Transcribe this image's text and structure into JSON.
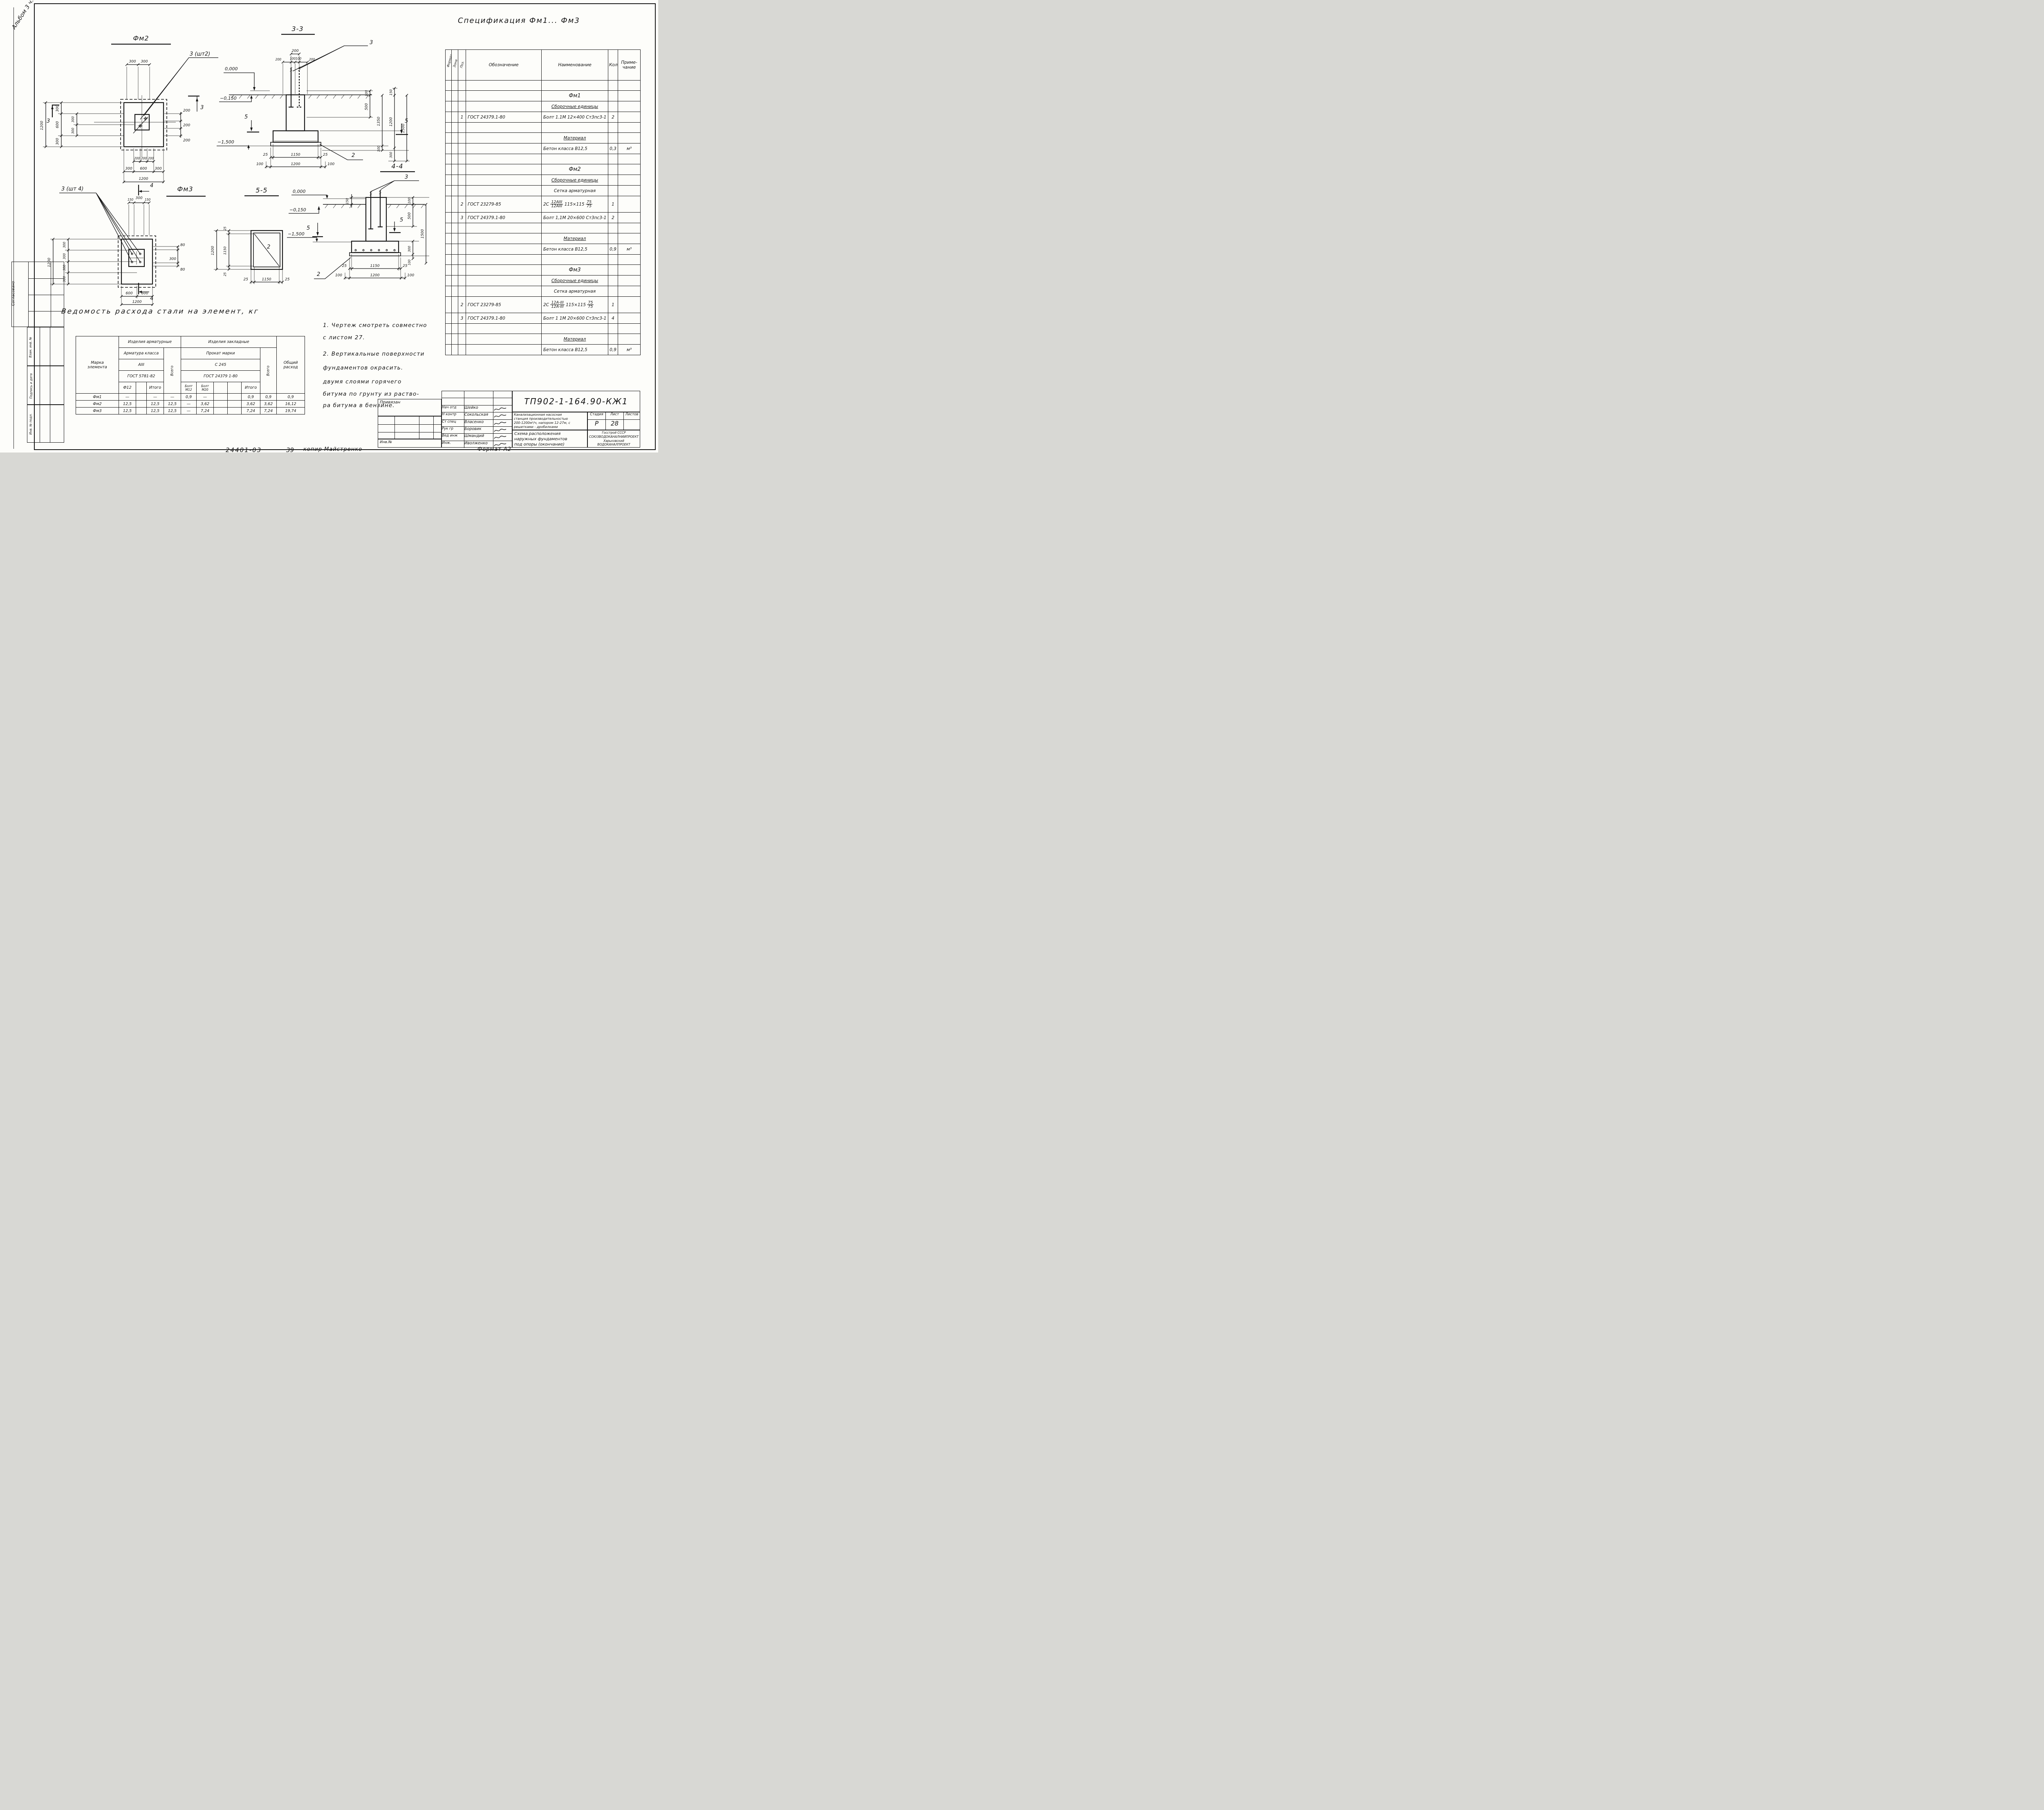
{
  "frame": {
    "album_note": "Альбом 3 ч.1",
    "stamp_agreed": "Согласовано",
    "stamp_vzam": "Взам. инв. №",
    "stamp_sign": "Подпись и дата",
    "stamp_inv": "Инв. № подл."
  },
  "footer": {
    "order_no": "24401-03",
    "num": "39",
    "copier": "копир Майстренко",
    "format": "Формат А2"
  },
  "fm2": {
    "title": "Фм2",
    "leader": "3 (шт2)",
    "mark": "3",
    "dims": {
      "top": [
        "300",
        "300"
      ],
      "left_total": "1200",
      "left_chain": [
        "300",
        "600",
        "300"
      ],
      "left_inner": [
        "300",
        "300"
      ],
      "right": [
        "200",
        "200",
        "200"
      ],
      "bot1": [
        "200",
        "200",
        "200"
      ],
      "bot2": [
        "300",
        "600",
        "300"
      ],
      "bot3": "1200"
    }
  },
  "s33": {
    "title": "3-3",
    "leader3": "3",
    "leader2": "2",
    "mark5": "5",
    "lev": [
      "0,000",
      "−0,150",
      "−1,500"
    ],
    "dims": {
      "t200": "200",
      "t100l": "100",
      "t100r": "100",
      "t200l": "200",
      "t200r": "200",
      "rA": [
        "100",
        "500"
      ],
      "rB": [
        "1350",
        "100"
      ],
      "rC": [
        "150",
        "1200",
        "300"
      ],
      "rD": "1500",
      "b1": [
        "25",
        "1150",
        "25"
      ],
      "b2": [
        "100",
        "1200",
        "100"
      ]
    }
  },
  "fm3": {
    "title": "Фм3",
    "leader": "3 (шт 4)",
    "mark4": "4",
    "dims": {
      "top": [
        "150",
        "300",
        "150"
      ],
      "left_total": "1200",
      "left_chain": [
        "300",
        "300",
        "300",
        "300"
      ],
      "right": [
        "80",
        "300",
        "80"
      ],
      "bot1": [
        "600",
        "600"
      ],
      "bot2": "1200"
    }
  },
  "s55": {
    "title": "5-5",
    "plate": "2",
    "dims": {
      "left_total": "1200",
      "left_chain": [
        "25",
        "1150",
        "25"
      ],
      "bot": [
        "25",
        "1150",
        "25"
      ]
    }
  },
  "s44": {
    "title": "4-4",
    "leader3": "3",
    "leader2": "2",
    "mark5": "5",
    "lev": [
      "0,000",
      "−0,150",
      "−1,500"
    ],
    "dims": {
      "l150": "150",
      "rA": [
        "100",
        "500"
      ],
      "r1500": "1500",
      "rB": [
        "300",
        "100"
      ],
      "b1": [
        "25",
        "1150",
        "25"
      ],
      "b2": [
        "100",
        "1200",
        "100"
      ]
    }
  },
  "steel": {
    "title": "Ведомость    расхода    стали    на    элемент, кг",
    "mark1": "Марка",
    "mark2": "элемента",
    "g1": "Изделия арматурные",
    "g2": "Изделия   закладные",
    "cls1": "Арматура класса",
    "v1": "АIII",
    "gost1": "ГОСТ 5781-82",
    "cls2": "Прокат       марки",
    "v2": "С 245",
    "gost2": "ГОСТ 24379 1-80",
    "f12": "Ф12",
    "itogo": "Итого",
    "vsego": "Всего",
    "m12a": "Болт",
    "m12b": "М12",
    "m20a": "Болт",
    "m20b": "М20",
    "total1": "Общий",
    "total2": "расход",
    "rows": [
      [
        "Фм1",
        "—",
        "",
        "—",
        "—",
        "0,9",
        "—",
        "",
        "",
        "0,9",
        "0,9",
        "0,9"
      ],
      [
        "Фм2",
        "12,5",
        "",
        "12,5",
        "12,5",
        "—",
        "3,62",
        "",
        "",
        "3,62",
        "3,62",
        "16,12"
      ],
      [
        "Фм3",
        "12,5",
        "",
        "12,5",
        "12,5",
        "—",
        "7,24",
        "",
        "",
        "7,24",
        "7,24",
        "19,74"
      ]
    ]
  },
  "notes": {
    "n1": "1.  Чертеж  смотреть  совместно",
    "n2": "с  листом  27.",
    "n3": "2. Вертикальные   поверхности",
    "n4": "фундаментов        окрасить.",
    "n5": "двумя      слоями      горячего",
    "n6": "битума   по   грунту   из раство-",
    "n7": "ра   битума    в  бензине."
  },
  "spec": {
    "title": "Спецификация      Фм1... Фм3",
    "h": {
      "fmt": "Формат",
      "zona": "Зона",
      "poz": "Поз.",
      "oboz": "Обозначение",
      "naim": "Наименование",
      "kol": "Кол.",
      "prim1": "Приме-",
      "prim2": "чание"
    },
    "fm1": {
      "name": "Фм1",
      "sub": "Сборочные единицы",
      "p1": "1",
      "g1": "ГОСТ 24379.1-80",
      "n1": "Болт 1.1М 12×400 Ст3пс3-1",
      "q1": "2",
      "mat": "Материал",
      "conc": "Бетон класса В12,5",
      "cq": "0,3",
      "cu": "м³"
    },
    "fm2": {
      "name": "Фм2",
      "sub": "Сборочные единицы",
      "mesh": "Сетка арматурная",
      "p2": "2",
      "g2": "ГОСТ 23279-85",
      "pre": "2С",
      "f1t": "12АIII",
      "f1b": "12АIII",
      "size": "115×115",
      "f2t": "75",
      "f2b": "75",
      "q2": "1",
      "p3": "3",
      "g3": "ГОСТ 24379.1-80",
      "n3": "Болт 1,1М 20×600 Ст3пс3-1",
      "q3": "2",
      "mat": "Материал",
      "conc": "Бетон класса В12,5",
      "cq": "0,9",
      "cu": "м³"
    },
    "fm3": {
      "name": "Фм3",
      "sub": "Сборочные единицы",
      "mesh": "Сетка арматурная",
      "p2": "2",
      "g2": "ГОСТ 23279-85",
      "pre": "2С",
      "f1t": "12А-III",
      "f1b": "12А-III",
      "size": "115×115",
      "f2t": "75",
      "f2b": "75",
      "q2": "1",
      "p3": "3",
      "g3": "ГОСТ 24379.1-80",
      "n3": "Болт 1 1М 20×600 Ст3пс3-1",
      "q3": "4",
      "mat": "Материал",
      "conc": "Бетон класса В12,5",
      "cq": "0,9",
      "cu": "м³"
    }
  },
  "tb": {
    "pin": "Привязан",
    "inv": "Инв.№",
    "doc": "ТП902-1-164.90-КЖ1",
    "roles": [
      [
        "Нач отд",
        "Шейко"
      ],
      [
        "Н контр",
        "Сокольская"
      ],
      [
        "Ст спец",
        "Власенко"
      ],
      [
        "Рук гр",
        "Боровик"
      ],
      [
        "Вед инж",
        "Шмандий"
      ],
      [
        "Инж.",
        "Иволженко"
      ]
    ],
    "pr1": "Канализационная насосная",
    "pr2": "станция производительностью",
    "pr3": "200-1200м³/ч, напором 12-27м, с",
    "pr4": "решетками - дробилками",
    "stadia": "Стадия",
    "list": "Лист",
    "listov": "Листов",
    "stadia_v": "Р",
    "list_v": "28",
    "listov_v": "",
    "t1": "Схема расположения",
    "t2": "наружных фундаментов",
    "t3": "под опоры (окончание)",
    "org1": "Госстрой СССР",
    "org2": "СОЮЗВОДОКАНАЛНИИПРОЕКТ",
    "org3": "Харьковский",
    "org4": "ВОДОКАНАЛПРОЕКТ"
  }
}
